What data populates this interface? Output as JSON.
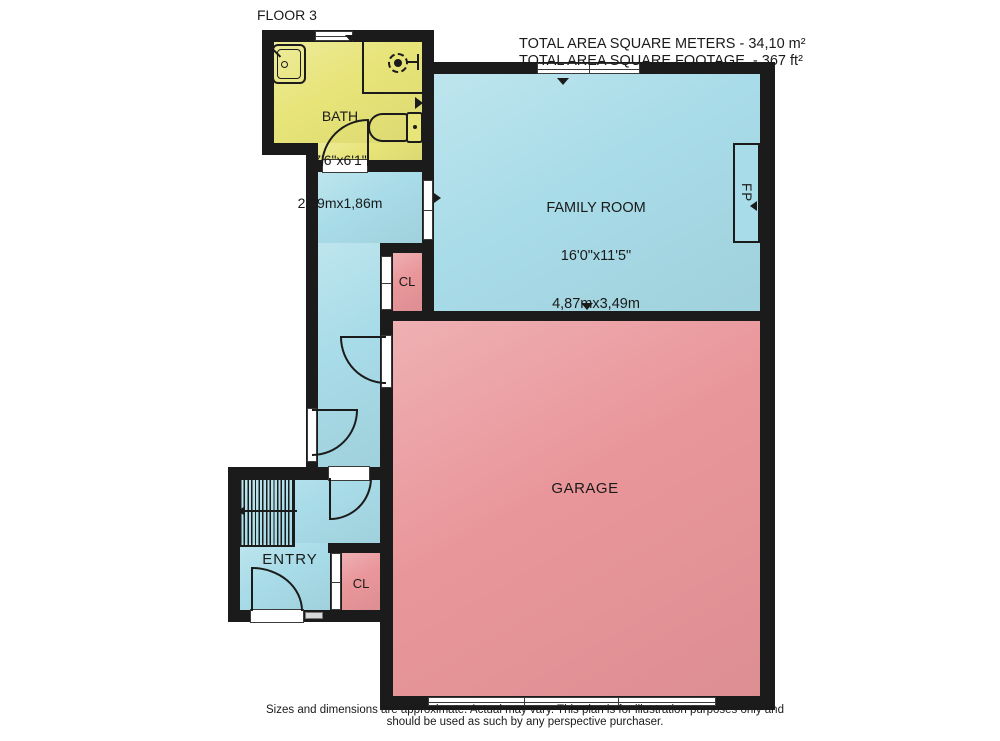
{
  "title": {
    "floor_label": "FLOOR 3"
  },
  "area_summary": {
    "square_meters_line": "TOTAL AREA SQUARE METERS - 34,10 m²",
    "square_footage_line": "TOTAL AREA SQUARE FOOTAGE  - 367 ft²"
  },
  "rooms": {
    "bath": {
      "name": "BATH",
      "dimensions_ft": "7'6\"x6'1\"",
      "dimensions_m": "2,29mx1,86m"
    },
    "family_room": {
      "name": "FAMILY ROOM",
      "dimensions_ft": "16'0\"x11'5\"",
      "dimensions_m": "4,87mx3,49m"
    },
    "garage": {
      "name": "GARAGE"
    },
    "entry": {
      "name": "ENTRY"
    },
    "closet_upper": {
      "name": "CL"
    },
    "closet_lower": {
      "name": "CL"
    },
    "fireplace": {
      "abbr": "FP"
    }
  },
  "disclaimer": {
    "line1": "Sizes and dimensions are approximate. Actual may vary. This plan is for illustration purposes only and",
    "line2": "should be used as such by any perspective purchaser."
  },
  "colors": {
    "wall": "#1B1B1B",
    "bath_yellow": "#E7E478",
    "room_blue": "#A8DCE8",
    "room_pink": "#E9969A",
    "background": "#FFFFFF"
  }
}
